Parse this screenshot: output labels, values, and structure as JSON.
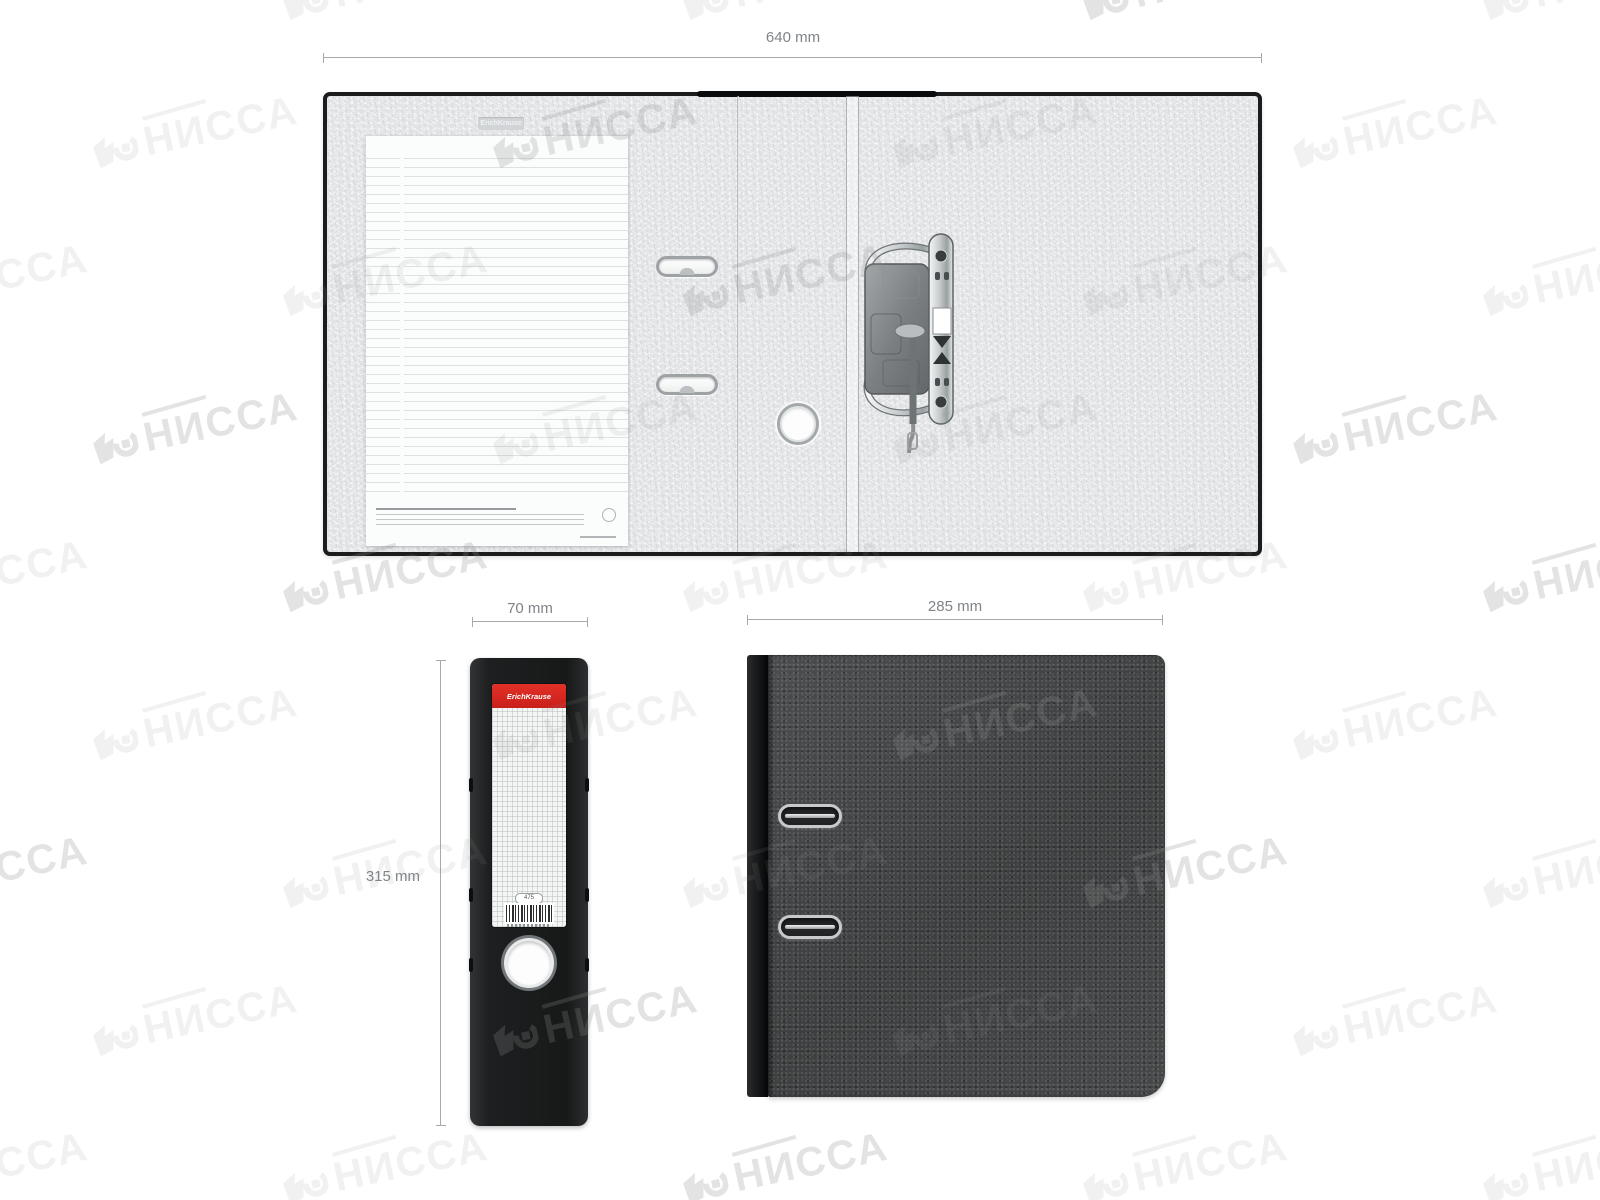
{
  "brand": "ErichKrause",
  "watermark": {
    "text": "НИССА"
  },
  "views": {
    "top": {
      "width_label": "640 mm"
    },
    "spine": {
      "width_label": "70 mm",
      "height_label": "315 mm",
      "barcode_tag": "475"
    },
    "front": {
      "width_label": "285 mm"
    }
  },
  "colors": {
    "dimension_gray": "#7f8488",
    "binder_interior": "#e2e4e6",
    "binder_edge": "#1b1c1e",
    "spine_black": "#1d1f20",
    "label_red": "#d8271f",
    "front_cover": "#434546",
    "watermark_gray": "#8f8f8f"
  }
}
